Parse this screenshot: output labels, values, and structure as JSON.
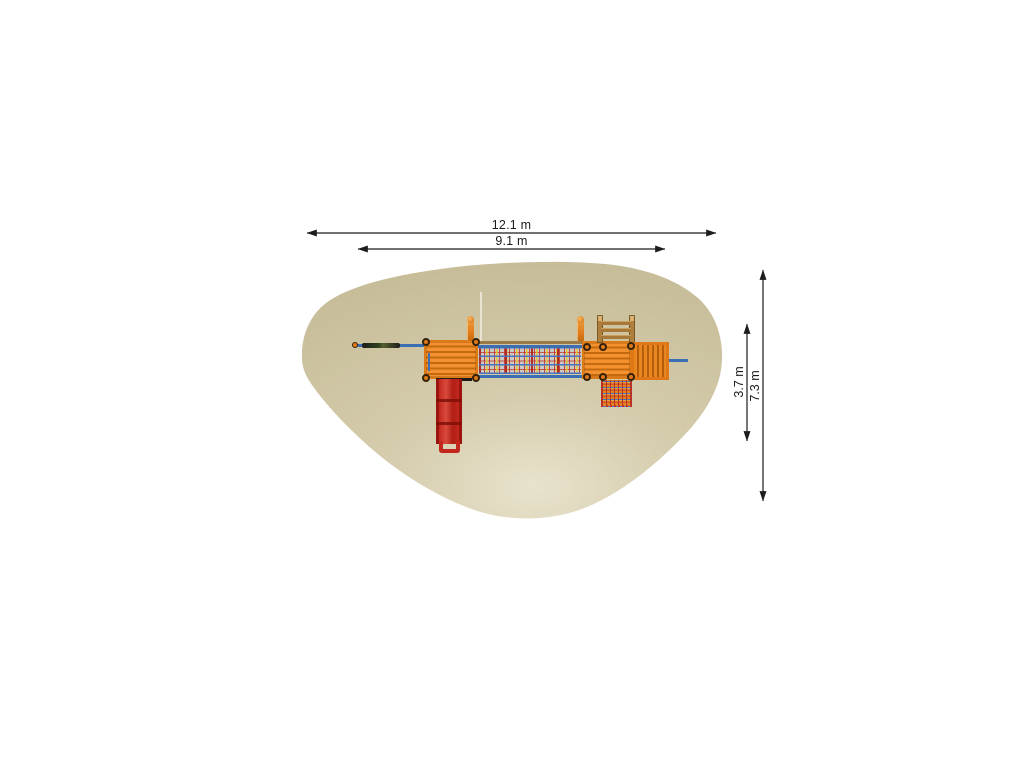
{
  "diagram": {
    "type": "playground-equipment-plan-top-view",
    "dimensions": {
      "total_width": {
        "label": "12.1 m",
        "orientation": "horizontal"
      },
      "inner_width": {
        "label": "9.1 m",
        "orientation": "horizontal"
      },
      "inner_depth": {
        "label": "3.7 m",
        "orientation": "vertical"
      },
      "total_depth": {
        "label": "7.3 m",
        "orientation": "vertical"
      }
    },
    "colors": {
      "background": "#ffffff",
      "safety_zone": "#cfc6a4",
      "safety_zone_light": "#e8e3cd",
      "wood_orange": "#e8821e",
      "wood_orange_dark": "#c46a0e",
      "slide_red": "#c3281e",
      "rail_blue": "#3c6eb4",
      "ladder_brown": "#b07f3e",
      "net_red": "#c03028",
      "net_yellow": "#e6c838",
      "dimension_line": "#1c1c1c"
    },
    "components": [
      "safety-zone",
      "monkey-bar",
      "platform-left",
      "slide",
      "net-bridge",
      "platform-right",
      "ladder",
      "climbing-ramp",
      "climbing-net",
      "finial-posts"
    ]
  }
}
